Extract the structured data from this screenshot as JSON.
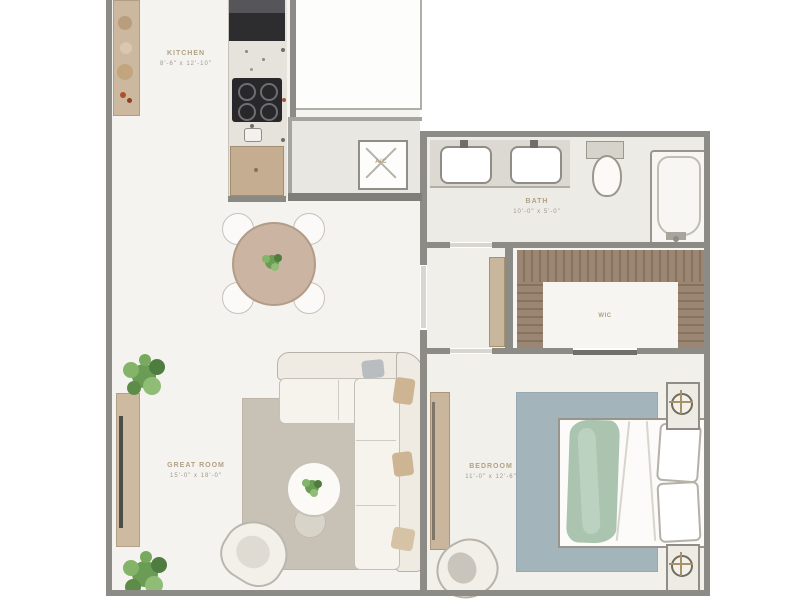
{
  "title": "apartment-floor-plan",
  "rooms": {
    "kitchen": {
      "name": "KITCHEN",
      "dims": "8'-6\" x 12'-10\""
    },
    "bath": {
      "name": "BATH",
      "dims": "10'-0\" x 5'-0\""
    },
    "great_room": {
      "name": "GREAT ROOM",
      "dims": "15'-0\" x 18'-0\""
    },
    "bedroom": {
      "name": "BEDROOM",
      "dims": "11'-0\" x 12'-6\""
    },
    "wic": {
      "name": "WIC"
    },
    "utility": {
      "ac_label": "A/C"
    }
  },
  "colors": {
    "wall": "#8c8b85",
    "floor": "#f5f3ef",
    "bath_floor": "#edebe5",
    "wood": "#c8b49a",
    "wardrobe_brown": "#9b8673",
    "rug_living": "#c8c1b5",
    "rug_bedroom": "#a4b4bb",
    "blanket_green": "#aac4af",
    "plant_green": "#6a9c55",
    "appliance_dark": "#2d2d30",
    "label_name": "#b1a185",
    "label_dims": "#9d988d"
  }
}
